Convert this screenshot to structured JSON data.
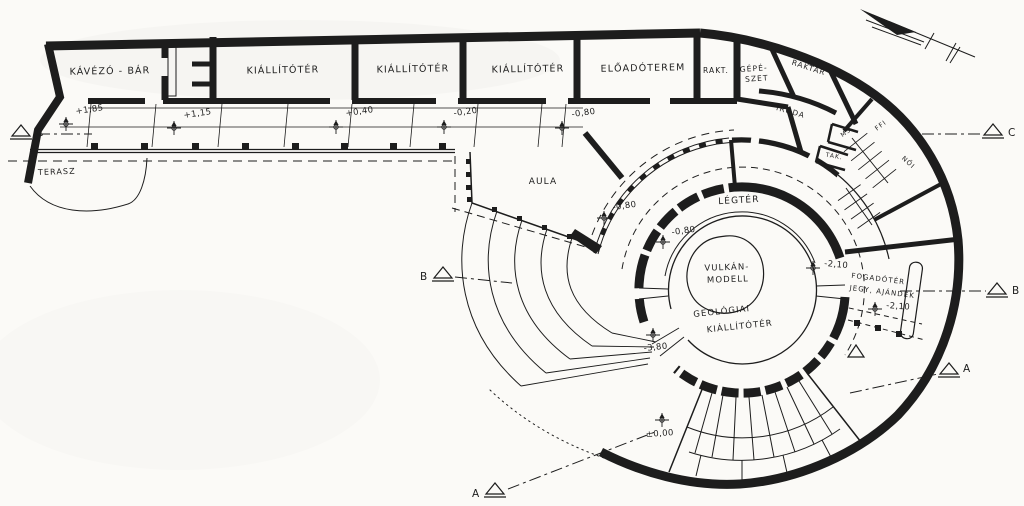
{
  "palette": {
    "paper": "#fbfaf7",
    "ink": "#1d1d1d"
  },
  "rooms": {
    "cafe_bar": "KÁVÉZÓ - BÁR",
    "exhibit_1": "KIÁLLÍTÓTÉR",
    "exhibit_2": "KIÁLLÍTÓTÉR",
    "exhibit_3": "KIÁLLÍTÓTÉR",
    "lecture_hall": "ELŐADÓTEREM",
    "storage_small": "RAKT.",
    "mechanical_line1": "GÉPÉ-",
    "mechanical_line2": "SZET",
    "storage_large": "RAKTÁR",
    "office": "IRODA",
    "washroom": "MS",
    "cleaning": "TAK.",
    "wc_men": "FFI",
    "wc_women": "NŐI",
    "terrace": "TERASZ",
    "atrium": "AULA",
    "air_space": "LÉGTÉR",
    "volcano_line1": "VULKÁN-",
    "volcano_line2": "MODELL",
    "geology_line1": "GEOLÓGIAI",
    "geology_line2": "KIÁLLÍTÓTÉR",
    "reception_line1": "FOGADÓTÉR",
    "reception_line2": "JEGY, AJÁNDÉK"
  },
  "levels": {
    "ramp_1": "+1,85",
    "ramp_2": "+1,15",
    "ramp_3": "+0,40",
    "ramp_4": "-0,20",
    "ramp_5": "-0,80",
    "aula_1": "-0,80",
    "aula_2": "-0,80",
    "ring_1": "-2,10",
    "reception": "-2,10",
    "geology": "-3,80",
    "entry": "±0,00"
  },
  "sections": {
    "c_left": "C",
    "c_right": "C",
    "b_left": "B",
    "b_right": "B",
    "a_bottom": "A",
    "a_right": "A"
  },
  "icons": {
    "compass": "north-arrow",
    "level_symbol": "benchmark-cross",
    "section_symbol": "section-triangle"
  }
}
